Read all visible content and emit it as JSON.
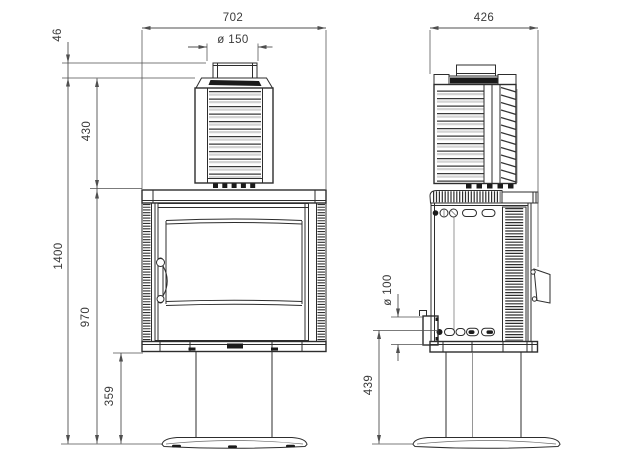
{
  "drawing": {
    "dimensions": {
      "front": {
        "width": "702",
        "flue_diameter": "ø 150",
        "flue_collar_height": "46",
        "upper_section_height": "430",
        "total_height": "1400",
        "body_top_height": "970",
        "pedestal_height": "359"
      },
      "side": {
        "depth": "426",
        "air_intake_diameter": "ø 100",
        "air_intake_height": "439"
      }
    },
    "colors": {
      "line": "#2d2d2d",
      "dim": "#4f4f4f",
      "text": "#3a3a3a",
      "ink": "#1b1b1b",
      "shade": "#d4d4d4",
      "bg": "#ffffff"
    }
  }
}
